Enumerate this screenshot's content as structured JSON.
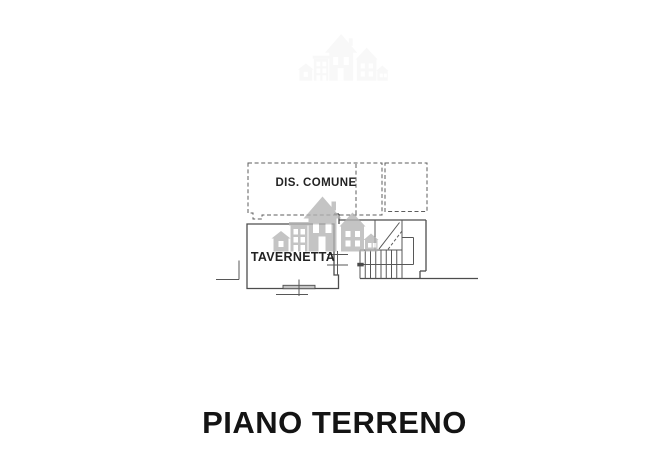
{
  "page": {
    "background": "#ffffff",
    "type": "floor-plan-drawing"
  },
  "plan": {
    "title": "PIANO TERRENO",
    "rooms": [
      {
        "id": "dis-comune",
        "label": "DIS. COMUNE"
      },
      {
        "id": "tavernetta",
        "label": "TAVERNETTA"
      }
    ]
  },
  "watermark": {
    "icon": "buildings-skyline-icon",
    "color": "#b4b4b4"
  },
  "colors": {
    "line": "#575757",
    "wall": "#4d4d4d",
    "label_text": "#232323",
    "title_text": "#141414",
    "watermark_gray": "#b4b4b4"
  }
}
